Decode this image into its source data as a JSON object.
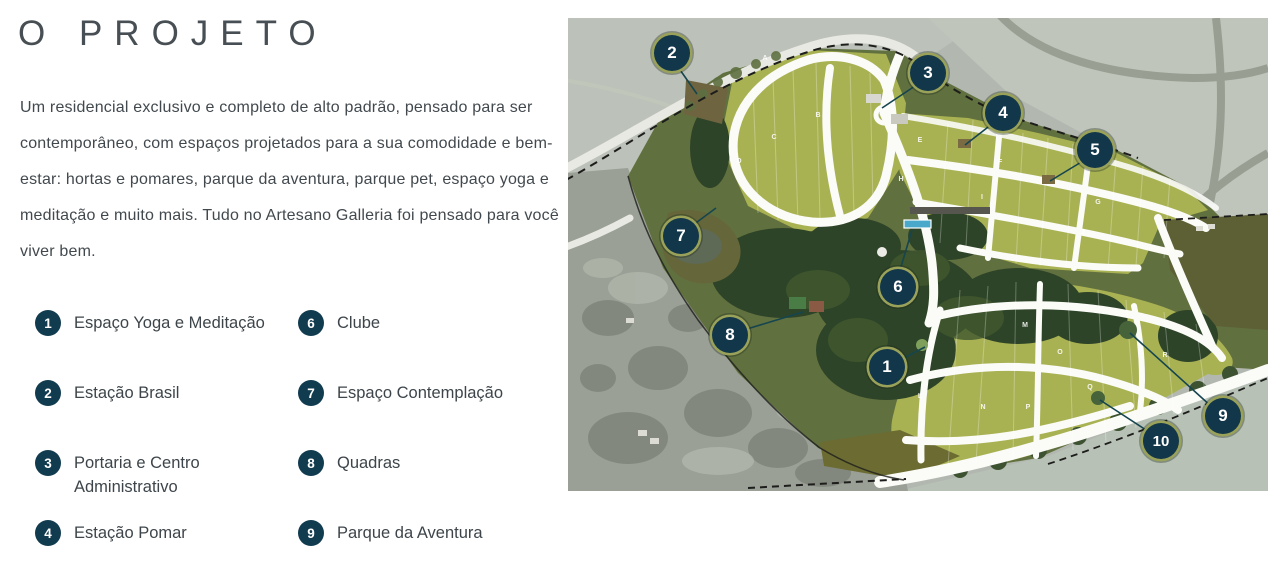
{
  "header": {
    "title": "O PROJETO"
  },
  "intro": {
    "text": "Um residencial exclusivo e completo de alto padrão, pensado para ser contemporâneo, com espaços projetados para a sua comodidade e bem-estar: hortas e pomares, parque da aventura, parque pet, espaço yoga e meditação e muito mais. Tudo no Artesano Galleria foi pensado para você viver bem."
  },
  "legend": {
    "columns": [
      {
        "items": [
          {
            "number": "1",
            "label": "Espaço Yoga e Meditação"
          },
          {
            "number": "2",
            "label": "Estação Brasil"
          },
          {
            "number": "3",
            "label": "Portaria e Centro Administrativo"
          },
          {
            "number": "4",
            "label": "Estação Pomar"
          }
        ]
      },
      {
        "items": [
          {
            "number": "6",
            "label": "Clube"
          },
          {
            "number": "7",
            "label": "Espaço Contemplação"
          },
          {
            "number": "8",
            "label": "Quadras"
          },
          {
            "number": "9",
            "label": "Parque da Aventura"
          }
        ]
      }
    ]
  },
  "map": {
    "markers": [
      {
        "number": "1"
      },
      {
        "number": "2"
      },
      {
        "number": "3"
      },
      {
        "number": "4"
      },
      {
        "number": "5"
      },
      {
        "number": "6"
      },
      {
        "number": "7"
      },
      {
        "number": "8"
      },
      {
        "number": "9"
      },
      {
        "number": "10"
      }
    ],
    "blocks": [
      {
        "letter": "A"
      },
      {
        "letter": "B"
      },
      {
        "letter": "C"
      },
      {
        "letter": "D"
      },
      {
        "letter": "E"
      },
      {
        "letter": "F"
      },
      {
        "letter": "G"
      },
      {
        "letter": "H"
      },
      {
        "letter": "I"
      },
      {
        "letter": "J"
      },
      {
        "letter": "K"
      },
      {
        "letter": "L"
      },
      {
        "letter": "M"
      },
      {
        "letter": "N"
      },
      {
        "letter": "O"
      },
      {
        "letter": "P"
      },
      {
        "letter": "Q"
      },
      {
        "letter": "R"
      }
    ]
  },
  "colors": {
    "badge": "#113b4f",
    "marker_fill": "#12364a",
    "marker_ring": "#9aa259",
    "site_green": "#a9b253",
    "title_text": "#474f54",
    "body_text": "#42494e"
  }
}
